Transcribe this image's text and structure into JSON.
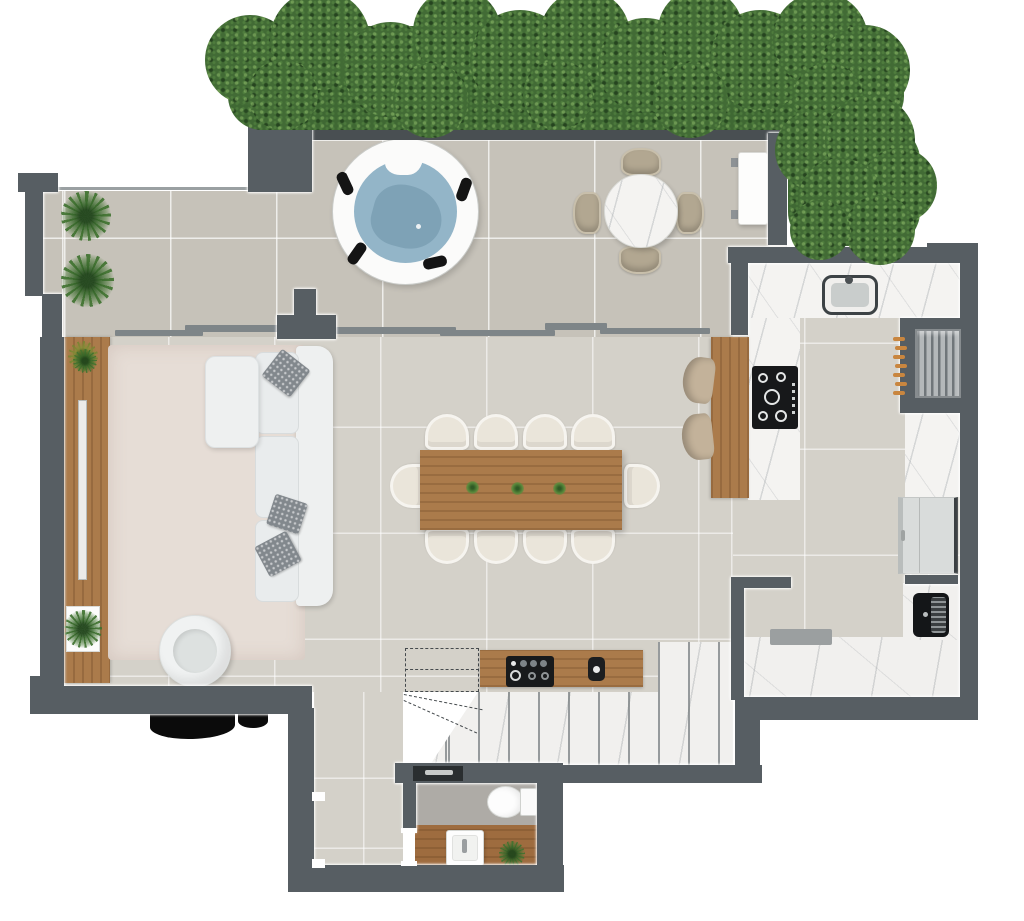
{
  "scene": {
    "title": "penthouse-floor-plan-top-down-render",
    "type": "architectural floor plan",
    "view": "top-down 3D render",
    "visible_text": "none"
  },
  "colors": {
    "wall": "#575e63",
    "wall_outline": "#ffffff",
    "terrace_tile": "#c6c2b9",
    "interior_tile": "#d4d1c9",
    "marble": "#f4f3f1",
    "wood": "#ab7b4b",
    "hedge_green": "#426b35",
    "hot_tub_water": "#93b5c8",
    "rug": "#e6ddd6",
    "sofa": "#eef0f0",
    "outdoor_chair": "#b2a791",
    "skewer_handles": "#c9863f",
    "background": "#ffffff"
  },
  "rooms": [
    {
      "name": "terrace",
      "items": [
        "privacy hedge (top)",
        "privacy hedge (right)",
        "round hot tub with 4 black headrests",
        "round marble bistro table",
        "4 outdoor chairs",
        "white bar counter",
        "2 potted ferns",
        "structural column"
      ]
    },
    {
      "name": "living-room",
      "items": [
        "wood media console with TV",
        "2 console plants",
        "area rug",
        "L-shaped white sectional sofa",
        "3 patterned throw pillows",
        "round swivel armchair",
        "sliding glass door track"
      ]
    },
    {
      "name": "dining-area",
      "items": [
        "rectangular wood dining table",
        "10 upholstered chairs",
        "3 small centerpiece plants"
      ]
    },
    {
      "name": "kitchen",
      "items": [
        "U-shaped marble counter",
        "undermount sink with faucet",
        "5-burner black cooktop",
        "wood island counter",
        "2 bar stools",
        "built-in grill with 7 skewers",
        "marble side counter",
        "double-door refrigerator",
        "black built-in appliance"
      ]
    },
    {
      "name": "stair-hall",
      "items": [
        "dashed stair outline (floor above)",
        "marble winder stairs",
        "wood coffee bar",
        "espresso machine set",
        "kettle",
        "marble service corridor",
        "floor mat"
      ]
    },
    {
      "name": "bathroom",
      "items": [
        "shower niche with fixture",
        "toilet with tank",
        "pedestal washbasin",
        "small plant",
        "wood floor strip"
      ]
    },
    {
      "name": "hallway",
      "items": [
        "tiled corridor",
        "door jambs"
      ]
    }
  ],
  "counts": {
    "dining_chairs": 10,
    "outdoor_chairs": 4,
    "bar_stools": 2,
    "hot_tub_headrests": 4,
    "throw_pillows": 3,
    "skewers": 7,
    "potted_plants": 6
  }
}
